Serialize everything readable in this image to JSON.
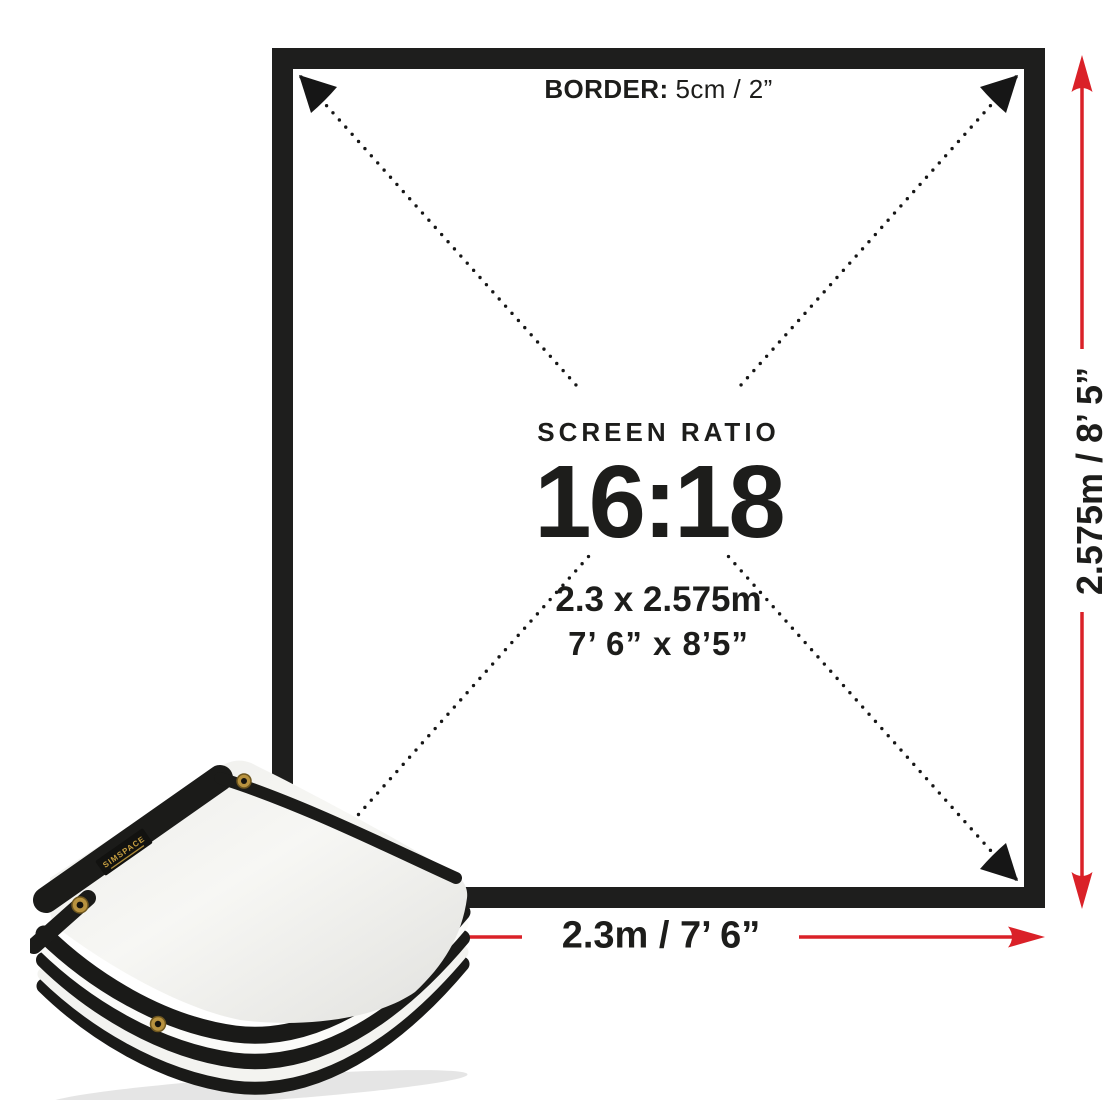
{
  "colors": {
    "accent_red": "#da2128",
    "frame_black": "#1e1e1d",
    "text_dark": "#1d1d1b",
    "fabric_gold": "#c8a041"
  },
  "frame": {
    "border_label": "BORDER:",
    "border_value": "5cm / 2”"
  },
  "center": {
    "title": "SCREEN RATIO",
    "ratio": "16:18",
    "metric_size": "2.3 x 2.575m",
    "imperial_size": "7’ 6” x 8’5”"
  },
  "dimensions": {
    "height": "2.575m / 8’ 5”",
    "width": "2.3m / 7’ 6”"
  },
  "product": {
    "brand": "SIMSPACE"
  }
}
